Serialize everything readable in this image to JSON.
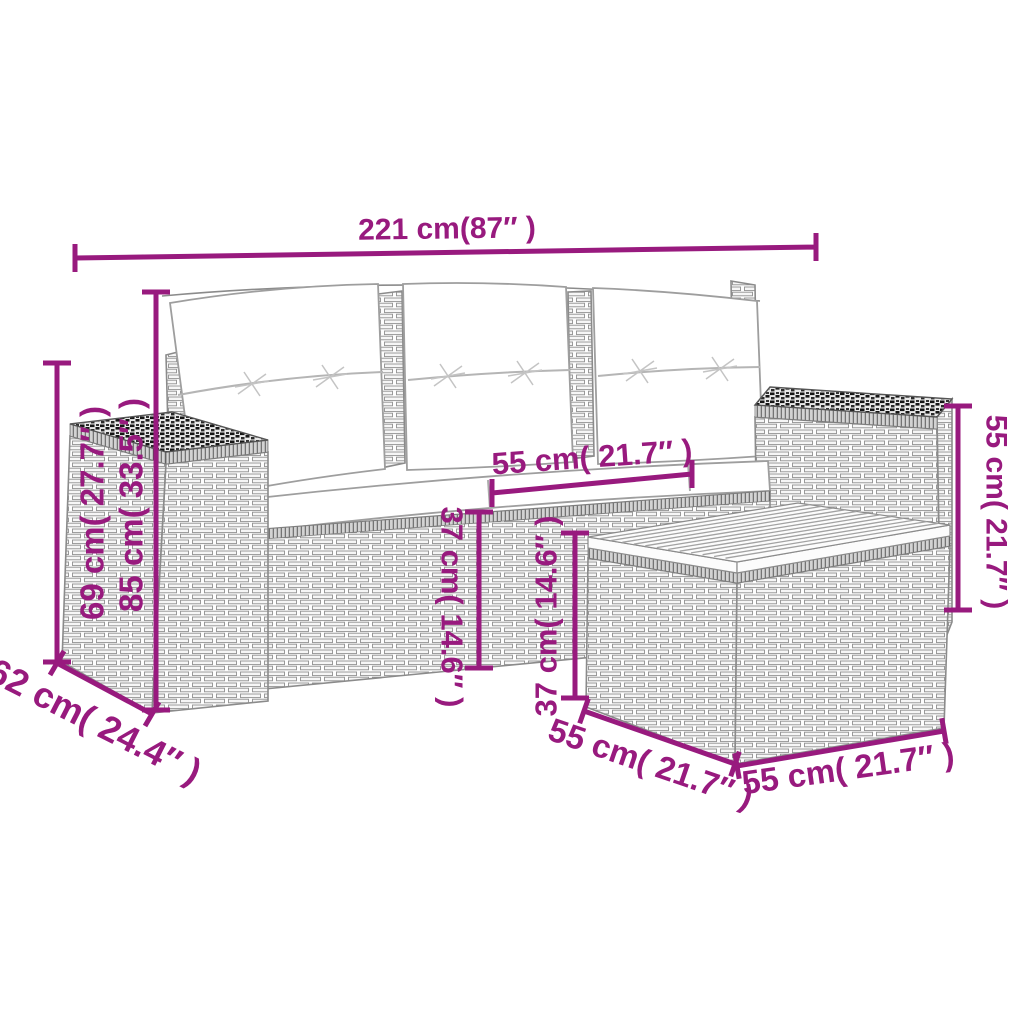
{
  "figure_type": "product-dimension-diagram",
  "accent_color": "#981A7E",
  "dims": {
    "overall_width": "221 cm(87″ )",
    "side_height": "69 cm( 27.7″ )",
    "back_height": "85 cm( 33.5″ )",
    "side_depth": "62 cm( 24.4″ )",
    "seat_width": "55 cm( 21.7″ )",
    "seat_height": "37 cm( 14.6″ )",
    "table_height": "37 cm( 14.6″ )",
    "armrest_height": "55 cm( 21.7″ )",
    "table_depth": "55 cm( 21.7″ )",
    "table_width": "55 cm( 21.7″ )"
  }
}
